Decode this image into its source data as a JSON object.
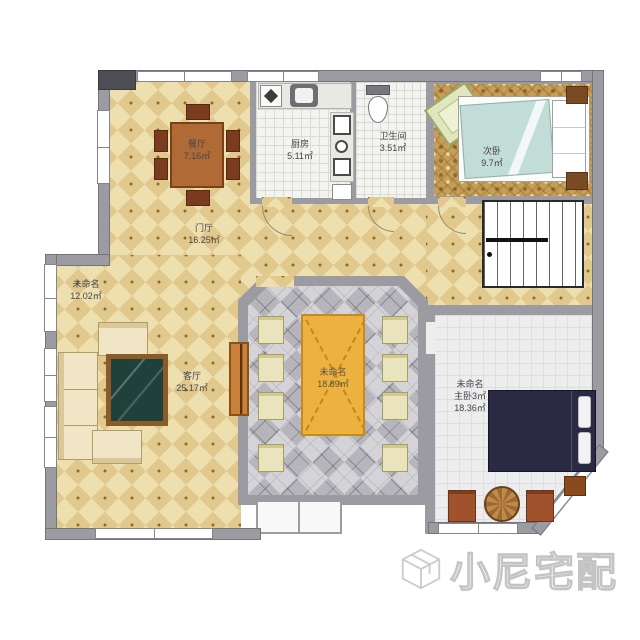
{
  "watermark": {
    "text": "小尼宅配"
  },
  "rooms": {
    "dining": {
      "name": "餐厅",
      "area": "7.16㎡"
    },
    "kitchen": {
      "name": "厨房",
      "area": "5.11㎡"
    },
    "bathroom": {
      "name": "卫生间",
      "area": "3.51㎡"
    },
    "bedroom2": {
      "name": "次卧",
      "area": "9.7㎡"
    },
    "hall": {
      "name": "门厅",
      "area": "16.25㎡"
    },
    "unnamed_left": {
      "name": "未命名",
      "area": "12.02㎡"
    },
    "living": {
      "name": "客厅",
      "area": "25.17㎡"
    },
    "unnamed_center": {
      "name": "未命名",
      "area": "18.89㎡"
    },
    "master": {
      "name": "未命名",
      "overlay": "主卧3㎡",
      "area": "18.36㎡"
    }
  },
  "colors": {
    "wall": "#9b9ba1",
    "hall_tile": "#eddfae",
    "carpet": "#c59e58",
    "center_tile": "#b5b5bb",
    "table_accent": "#edb13f",
    "bed_navy": "#2a2a44",
    "blanket_teal": "#c2dcd8"
  }
}
